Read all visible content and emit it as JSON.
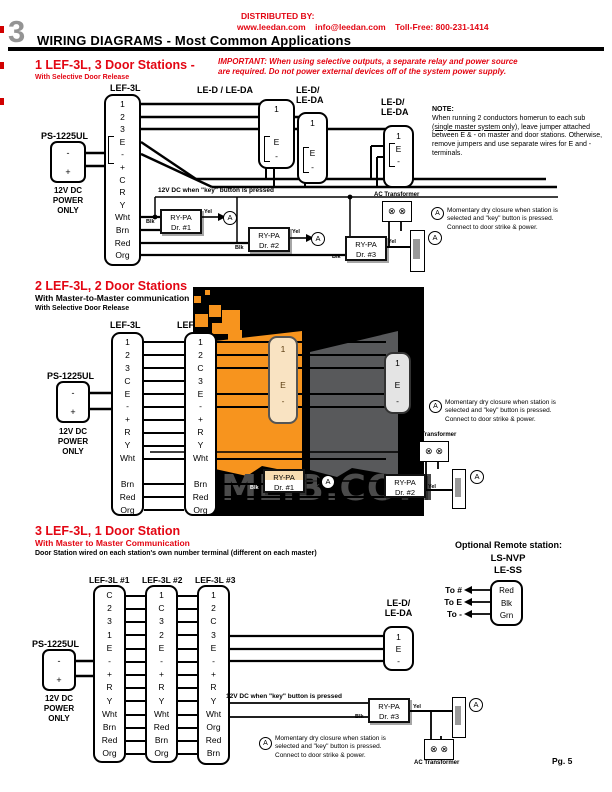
{
  "header": {
    "chapter": "3",
    "title": "WIRING DIAGRAMS - Most Common Applications",
    "distributed_by": "DISTRIBUTED BY:",
    "distributor_info": "www.leedan.com    info@leedan.com    Toll-Free: 800-231-1414"
  },
  "watermark": {
    "text": "UMLIB.COM"
  },
  "shared": {
    "power_label": "PS-1225UL",
    "power_terminals": [
      "-",
      "+"
    ],
    "power_caption": [
      "12V DC",
      "POWER",
      "ONLY"
    ],
    "relay_in": "Blk",
    "relay_out": "Yel",
    "transformer_label": "AC Transformer",
    "transformer_symbol": "⊗",
    "key_note": "12V DC when \"key\" button is pressed",
    "closure_symbol": "A",
    "closure_note": [
      "Momentary dry closure when station is",
      "selected and \"key\" button is pressed.",
      "Connect to door strike & power."
    ],
    "door_terminals": [
      "1",
      "E",
      "-"
    ]
  },
  "section1": {
    "title": "1 LEF-3L, 3 Door Stations -",
    "subtitle": "With Selective Door Release",
    "important": [
      "IMPORTANT: When using selective outputs, a separate relay and power source",
      "are required. Do not power external devices off of the system power supply."
    ],
    "master_label": "LEF-3L",
    "master_terminals": [
      "1",
      "2",
      "3",
      "E",
      "-",
      "+",
      "C",
      "R",
      "Y",
      "Wht",
      "Brn",
      "Red",
      "Org"
    ],
    "door1_label": "LE-D / LE-DA",
    "door2_label": [
      "LE-D/",
      "LE-DA"
    ],
    "door3_label": [
      "LE-D/",
      "LE-DA"
    ],
    "note_heading": "NOTE:",
    "note_pre": "When running 2 conductors homerun to each sub ",
    "note_underlined": "(single master system only)",
    "note_post": ", leave jumper attached between E & - on master and door stations. Otherwise, remove jumpers and use separate wires for E and - terminals.",
    "relays": [
      [
        "RY-PA",
        "Dr. #1"
      ],
      [
        "RY-PA",
        "Dr. #2"
      ],
      [
        "RY-PA",
        "Dr. #3"
      ]
    ]
  },
  "section2": {
    "title": "2 LEF-3L, 2 Door Stations",
    "subtitle1": "With Master-to-Master communication",
    "subtitle2": "With Selective Door Release",
    "master1_label": "LEF-3L",
    "master2_label": "LEF-3L",
    "master1_terminals": [
      "1",
      "2",
      "3",
      "C",
      "E",
      "-",
      "+",
      "R",
      "Y",
      "Wht",
      "",
      "Brn",
      "Red",
      "Org"
    ],
    "master2_terminals": [
      "1",
      "2",
      "C",
      "3",
      "E",
      "-",
      "+",
      "R",
      "Y",
      "Wht",
      "",
      "Brn",
      "Red",
      "Org"
    ],
    "relays": [
      [
        "RY-PA",
        "Dr. #1"
      ],
      [
        "RY-PA",
        "Dr. #2"
      ]
    ]
  },
  "section3": {
    "title": "3 LEF-3L, 1 Door Station",
    "subtitle1": "With Master to Master Communication",
    "subtitle2": "Door Station wired on each station's own number terminal (different on each master)",
    "optional_label": "Optional Remote station:",
    "remote_model1": "LS-NVP",
    "remote_model2": "LE-SS",
    "remote_terminals": [
      "Red",
      "Blk",
      "Grn"
    ],
    "remote_to": [
      "To #",
      "To E",
      "To -"
    ],
    "master_labels": [
      "LEF-3L #1",
      "LEF-3L #2",
      "LEF-3L #3"
    ],
    "master1_terminals": [
      "C",
      "2",
      "3",
      "1",
      "E",
      "-",
      "+",
      "R",
      "Y",
      "Wht",
      "Brn",
      "Red",
      "Org"
    ],
    "master2_terminals": [
      "1",
      "C",
      "3",
      "2",
      "E",
      "-",
      "+",
      "R",
      "Y",
      "Wht",
      "Red",
      "Brn",
      "Org"
    ],
    "master3_terminals": [
      "1",
      "2",
      "C",
      "3",
      "E",
      "-",
      "+",
      "R",
      "Y",
      "Wht",
      "Org",
      "Red",
      "Brn"
    ],
    "door_label": [
      "LE-D/",
      "LE-DA"
    ],
    "relay": [
      "RY-PA",
      "Dr. #3"
    ],
    "page_number": "Pg. 5"
  }
}
